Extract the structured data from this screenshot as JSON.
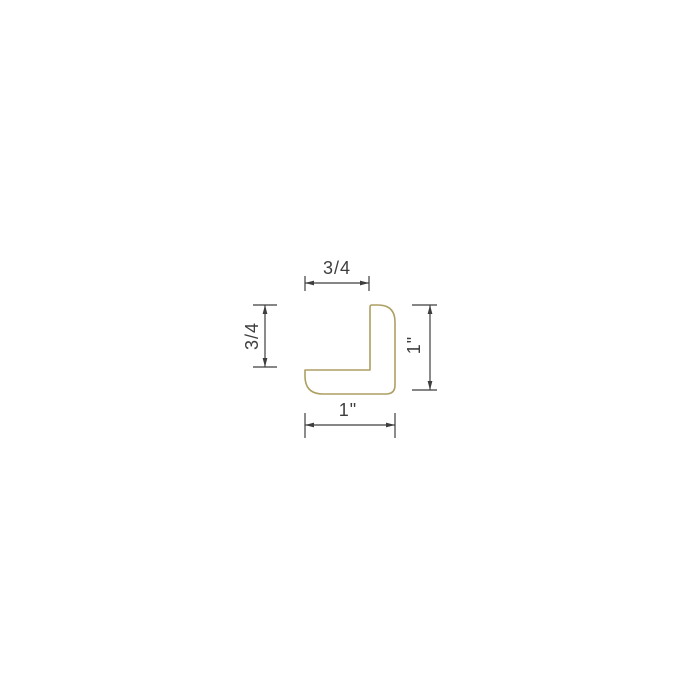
{
  "drawing": {
    "kind": "cross-section technical drawing",
    "shape": "L-shaped corner profile",
    "profile_stroke_color": "#ae9f63",
    "dimension_color": "#3e3e3e",
    "dimensions": {
      "top_width": "3/4",
      "left_height": "3/4",
      "right_height": "1\"",
      "bottom_width": "1\""
    }
  }
}
